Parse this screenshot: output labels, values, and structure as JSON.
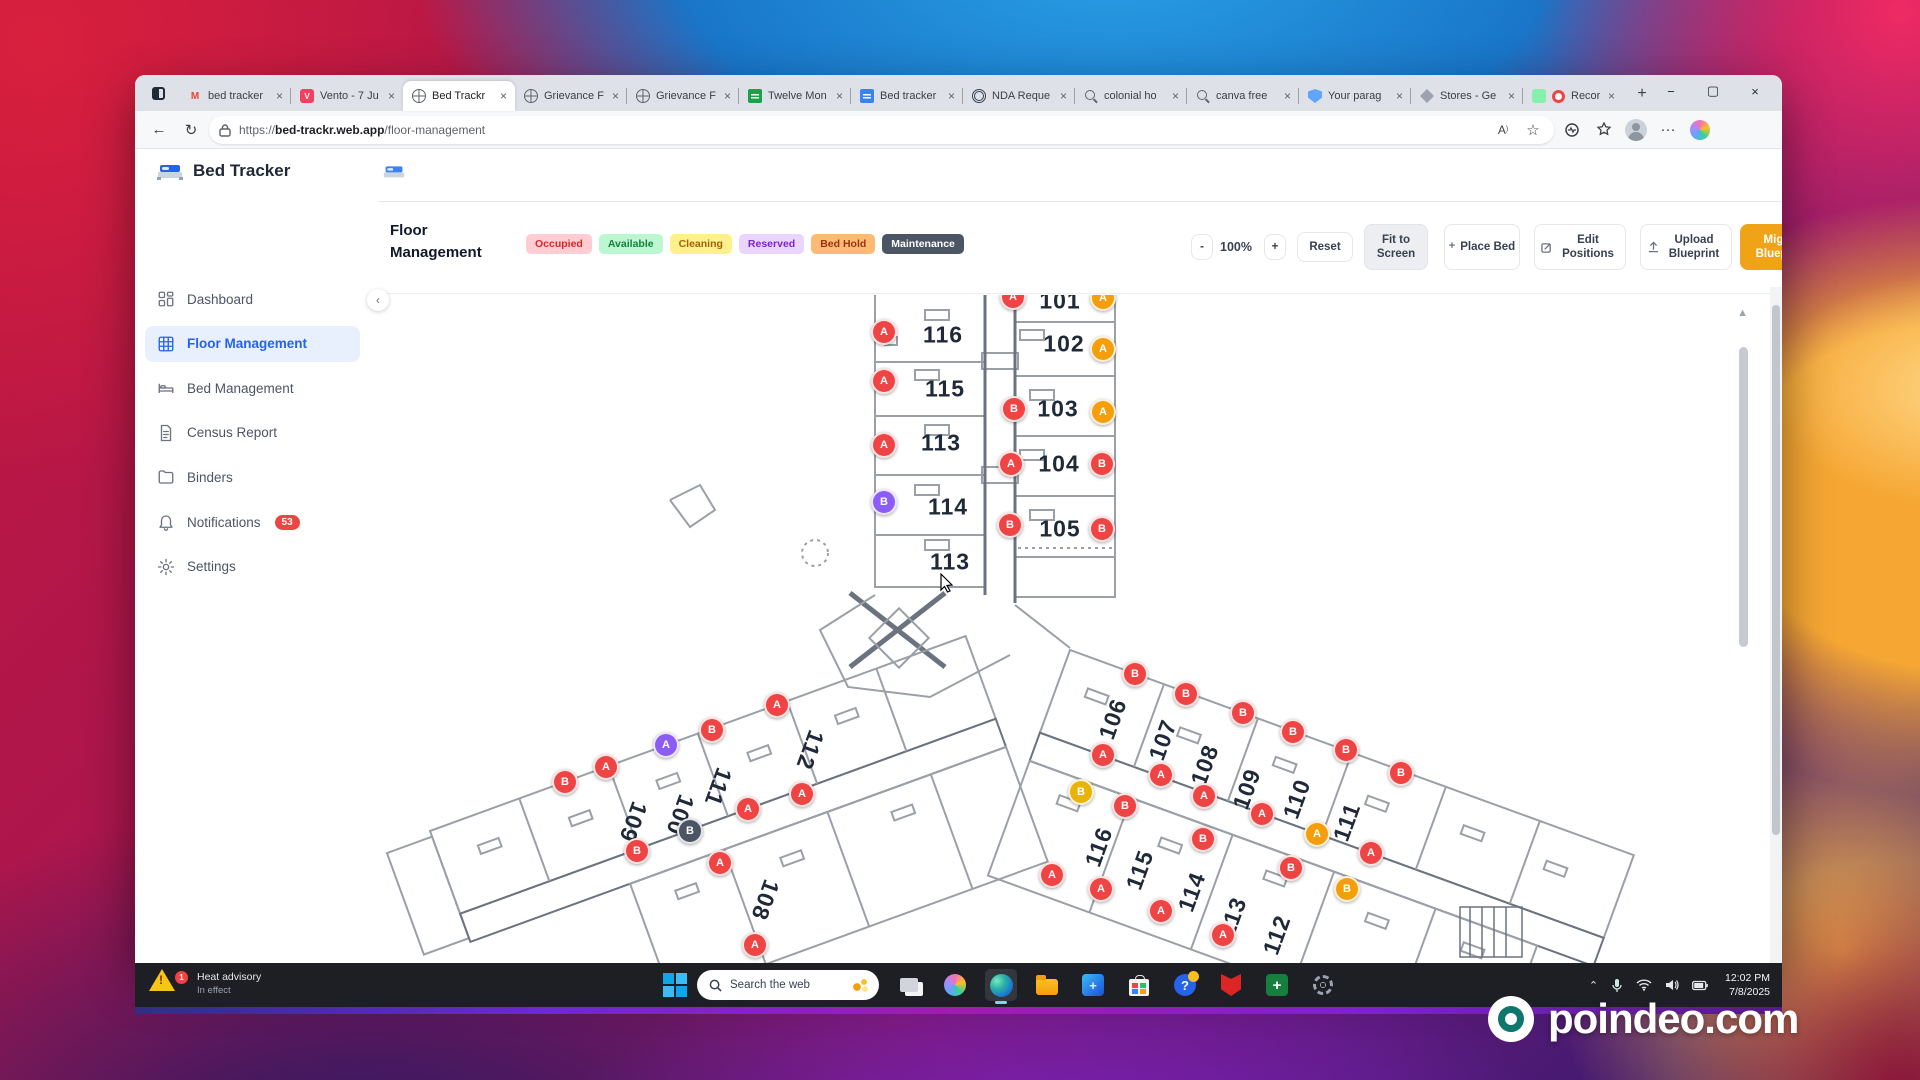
{
  "browser": {
    "tabs": [
      {
        "icon": "gmail-icon",
        "label": "bed tracker"
      },
      {
        "icon": "vento-icon",
        "label": "Vento - 7 Ju"
      },
      {
        "icon": "globe-icon",
        "label": "Bed Trackr",
        "active": true
      },
      {
        "icon": "globe-icon",
        "label": "Grievance F"
      },
      {
        "icon": "globe-icon",
        "label": "Grievance F"
      },
      {
        "icon": "sheets-icon",
        "label": "Twelve Mon"
      },
      {
        "icon": "docs-icon",
        "label": "Bed tracker"
      },
      {
        "icon": "nda-icon",
        "label": "NDA Reque"
      },
      {
        "icon": "search-icon",
        "label": "colonial ho"
      },
      {
        "icon": "search-icon",
        "label": "canva free"
      },
      {
        "icon": "shield-icon",
        "label": "Your parag"
      },
      {
        "icon": "diamond-icon",
        "label": "Stores - Ge"
      },
      {
        "icon": "record-icon",
        "label": "Record",
        "extra_icon": "record-dot-icon"
      }
    ],
    "close_glyph": "×",
    "new_tab_glyph": "+",
    "window_controls": {
      "minimize": "−",
      "maximize": "▢",
      "close": "×"
    },
    "nav": {
      "back": "←",
      "reload": "↻",
      "url_bold": "bed-trackr.web.app",
      "url_prefix": "https://",
      "url_path": "/floor-management",
      "read_aloud": "A",
      "more": "···"
    }
  },
  "app": {
    "brand": "Bed Tracker",
    "sidebar": [
      {
        "icon": "dashboard-icon",
        "label": "Dashboard"
      },
      {
        "icon": "floor-grid-icon",
        "label": "Floor Management",
        "active": true
      },
      {
        "icon": "bed-icon",
        "label": "Bed Management"
      },
      {
        "icon": "census-doc-icon",
        "label": "Census Report"
      },
      {
        "icon": "binders-folder-icon",
        "label": "Binders"
      },
      {
        "icon": "bell-icon",
        "label": "Notifications",
        "badge": "53"
      },
      {
        "icon": "gear-icon",
        "label": "Settings"
      }
    ],
    "logout": "Logout",
    "collapse_glyph": "‹",
    "toolbar": {
      "title_line1": "Floor",
      "title_line2": "Management",
      "legend": [
        {
          "label": "Occupied",
          "bg": "#fecdd3",
          "color": "#dc2626"
        },
        {
          "label": "Available",
          "bg": "#bbf7d0",
          "color": "#15803d"
        },
        {
          "label": "Cleaning",
          "bg": "#fef08a",
          "color": "#a16207"
        },
        {
          "label": "Reserved",
          "bg": "#e9d5ff",
          "color": "#7e22ce"
        },
        {
          "label": "Bed Hold",
          "bg": "#fdba74",
          "color": "#9a3412"
        },
        {
          "label": "Maintenance",
          "bg": "#4b5563",
          "color": "#ffffff"
        }
      ],
      "zoom_out": "-",
      "zoom_level": "100%",
      "zoom_in": "+",
      "reset": "Reset",
      "fit": "Fit to Screen",
      "place": "Place Bed",
      "edit": "Edit Positions",
      "upload": "Upload Blueprint",
      "migrate": "Migrate Blueprints",
      "migrate_bg": "#f0a317",
      "using": "Using %",
      "using_bg": "#dbeafe",
      "using_color": "#1d4ed8",
      "page": "1",
      "page_caret": "▾"
    },
    "floor_plan": {
      "marker_colors": {
        "red": "#ef4444",
        "orange": "#f59e0b",
        "yellow": "#eab308",
        "purple": "#8b5cf6",
        "gray": "#4b5563"
      },
      "markers": [
        {
          "l": "A",
          "c": "red",
          "x": 643,
          "y": 2
        },
        {
          "l": "A",
          "c": "orange",
          "x": 733,
          "y": 3
        },
        {
          "l": "A",
          "c": "red",
          "x": 514,
          "y": 37
        },
        {
          "l": "A",
          "c": "orange",
          "x": 733,
          "y": 54
        },
        {
          "l": "A",
          "c": "red",
          "x": 514,
          "y": 86
        },
        {
          "l": "B",
          "c": "red",
          "x": 644,
          "y": 114
        },
        {
          "l": "A",
          "c": "orange",
          "x": 733,
          "y": 117
        },
        {
          "l": "A",
          "c": "red",
          "x": 514,
          "y": 150
        },
        {
          "l": "A",
          "c": "red",
          "x": 641,
          "y": 169
        },
        {
          "l": "B",
          "c": "red",
          "x": 732,
          "y": 169
        },
        {
          "l": "B",
          "c": "purple",
          "x": 514,
          "y": 207
        },
        {
          "l": "B",
          "c": "red",
          "x": 640,
          "y": 230
        },
        {
          "l": "B",
          "c": "red",
          "x": 732,
          "y": 234
        },
        {
          "l": "A",
          "c": "red",
          "x": 407,
          "y": 410
        },
        {
          "l": "B",
          "c": "red",
          "x": 342,
          "y": 435
        },
        {
          "l": "A",
          "c": "purple",
          "x": 296,
          "y": 450
        },
        {
          "l": "A",
          "c": "red",
          "x": 236,
          "y": 472
        },
        {
          "l": "B",
          "c": "red",
          "x": 195,
          "y": 487
        },
        {
          "l": "A",
          "c": "red",
          "x": 432,
          "y": 499
        },
        {
          "l": "A",
          "c": "red",
          "x": 378,
          "y": 514
        },
        {
          "l": "B",
          "c": "gray",
          "x": 320,
          "y": 536
        },
        {
          "l": "B",
          "c": "red",
          "x": 267,
          "y": 556
        },
        {
          "l": "A",
          "c": "red",
          "x": 350,
          "y": 568
        },
        {
          "l": "A",
          "c": "red",
          "x": 385,
          "y": 650
        },
        {
          "l": "B",
          "c": "red",
          "x": 765,
          "y": 379
        },
        {
          "l": "B",
          "c": "red",
          "x": 816,
          "y": 399
        },
        {
          "l": "B",
          "c": "red",
          "x": 873,
          "y": 418
        },
        {
          "l": "B",
          "c": "red",
          "x": 923,
          "y": 437
        },
        {
          "l": "B",
          "c": "red",
          "x": 976,
          "y": 455
        },
        {
          "l": "B",
          "c": "red",
          "x": 1031,
          "y": 478
        },
        {
          "l": "A",
          "c": "red",
          "x": 733,
          "y": 460
        },
        {
          "l": "A",
          "c": "red",
          "x": 791,
          "y": 480
        },
        {
          "l": "A",
          "c": "red",
          "x": 834,
          "y": 501
        },
        {
          "l": "A",
          "c": "red",
          "x": 892,
          "y": 519
        },
        {
          "l": "A",
          "c": "orange",
          "x": 947,
          "y": 539
        },
        {
          "l": "A",
          "c": "red",
          "x": 1001,
          "y": 558
        },
        {
          "l": "B",
          "c": "yellow",
          "x": 711,
          "y": 497
        },
        {
          "l": "B",
          "c": "red",
          "x": 755,
          "y": 511
        },
        {
          "l": "B",
          "c": "red",
          "x": 833,
          "y": 544
        },
        {
          "l": "B",
          "c": "red",
          "x": 921,
          "y": 573
        },
        {
          "l": "B",
          "c": "orange",
          "x": 977,
          "y": 594
        },
        {
          "l": "A",
          "c": "red",
          "x": 682,
          "y": 580
        },
        {
          "l": "A",
          "c": "red",
          "x": 731,
          "y": 594
        },
        {
          "l": "A",
          "c": "red",
          "x": 791,
          "y": 616
        },
        {
          "l": "A",
          "c": "red",
          "x": 853,
          "y": 640
        }
      ],
      "rooms": [
        {
          "n": "101",
          "x": 690,
          "y": 6,
          "r": 0
        },
        {
          "n": "116",
          "x": 573,
          "y": 40,
          "r": 0
        },
        {
          "n": "102",
          "x": 694,
          "y": 49,
          "r": 0
        },
        {
          "n": "115",
          "x": 575,
          "y": 94,
          "r": 0
        },
        {
          "n": "103",
          "x": 688,
          "y": 114,
          "r": 0
        },
        {
          "n": "113",
          "x": 571,
          "y": 148,
          "r": 0
        },
        {
          "n": "104",
          "x": 689,
          "y": 169,
          "r": 0
        },
        {
          "n": "114",
          "x": 578,
          "y": 212,
          "r": 0
        },
        {
          "n": "105",
          "x": 690,
          "y": 234,
          "r": 0
        },
        {
          "n": "113",
          "x": 580,
          "y": 267,
          "r": 0
        },
        {
          "n": "109",
          "x": 263,
          "y": 527,
          "r": 110
        },
        {
          "n": "100",
          "x": 310,
          "y": 520,
          "r": 110
        },
        {
          "n": "111",
          "x": 348,
          "y": 492,
          "r": 110
        },
        {
          "n": "112",
          "x": 440,
          "y": 455,
          "r": 110
        },
        {
          "n": "108",
          "x": 395,
          "y": 605,
          "r": 110
        },
        {
          "n": "106",
          "x": 743,
          "y": 424,
          "r": -70
        },
        {
          "n": "107",
          "x": 793,
          "y": 445,
          "r": -70
        },
        {
          "n": "108",
          "x": 835,
          "y": 470,
          "r": -70
        },
        {
          "n": "109",
          "x": 877,
          "y": 494,
          "r": -70
        },
        {
          "n": "110",
          "x": 927,
          "y": 504,
          "r": -70
        },
        {
          "n": "111",
          "x": 977,
          "y": 527,
          "r": -70
        },
        {
          "n": "116",
          "x": 729,
          "y": 552,
          "r": -70
        },
        {
          "n": "115",
          "x": 770,
          "y": 575,
          "r": -70
        },
        {
          "n": "114",
          "x": 822,
          "y": 597,
          "r": -70
        },
        {
          "n": "113",
          "x": 863,
          "y": 622,
          "r": -70
        },
        {
          "n": "112",
          "x": 907,
          "y": 640,
          "r": -70
        }
      ]
    }
  },
  "taskbar": {
    "weather_line1": "Heat advisory",
    "weather_line2": "In effect",
    "weather_badge": "1",
    "search_placeholder": "Search the web",
    "icons": [
      "task-view-icon",
      "copilot-icon",
      "edge-icon",
      "file-explorer-icon",
      "health-app-icon",
      "store-icon",
      "help-icon",
      "mcafee-icon",
      "excel-icon",
      "settings-gear-icon"
    ],
    "open_icon": "edge-icon",
    "tray_time": "12:02 PM",
    "tray_date": "7/8/2025"
  },
  "watermark": "poindeo.com"
}
